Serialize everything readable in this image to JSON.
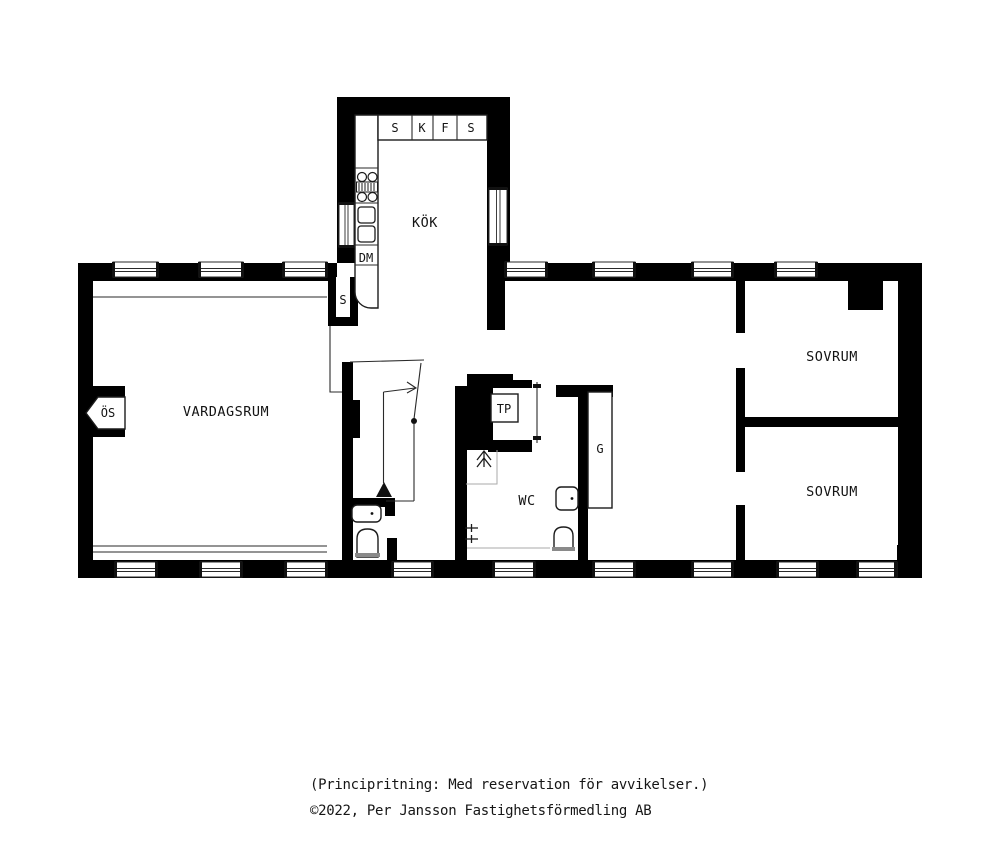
{
  "plan": {
    "labels": {
      "kitchen": "KÖK",
      "living_room": "VARDAGSRUM",
      "bedroom_top": "SOVRUM",
      "bedroom_bottom": "SOVRUM",
      "wc": "WC",
      "cabinet_1": "S",
      "cabinet_2": "K",
      "cabinet_3": "F",
      "cabinet_4": "S",
      "dishwasher": "DM",
      "hall_closet": "S",
      "fireplace": "ÖS",
      "drying_cabinet": "TP",
      "wardrobe": "G"
    },
    "colors": {
      "wall": "#000000",
      "background": "#ffffff",
      "thin_line": "#2a2a2a"
    }
  },
  "footer": {
    "line1": "(Principritning: Med reservation för avvikelser.)",
    "line2": "©2022, Per Jansson Fastighetsförmedling AB"
  }
}
